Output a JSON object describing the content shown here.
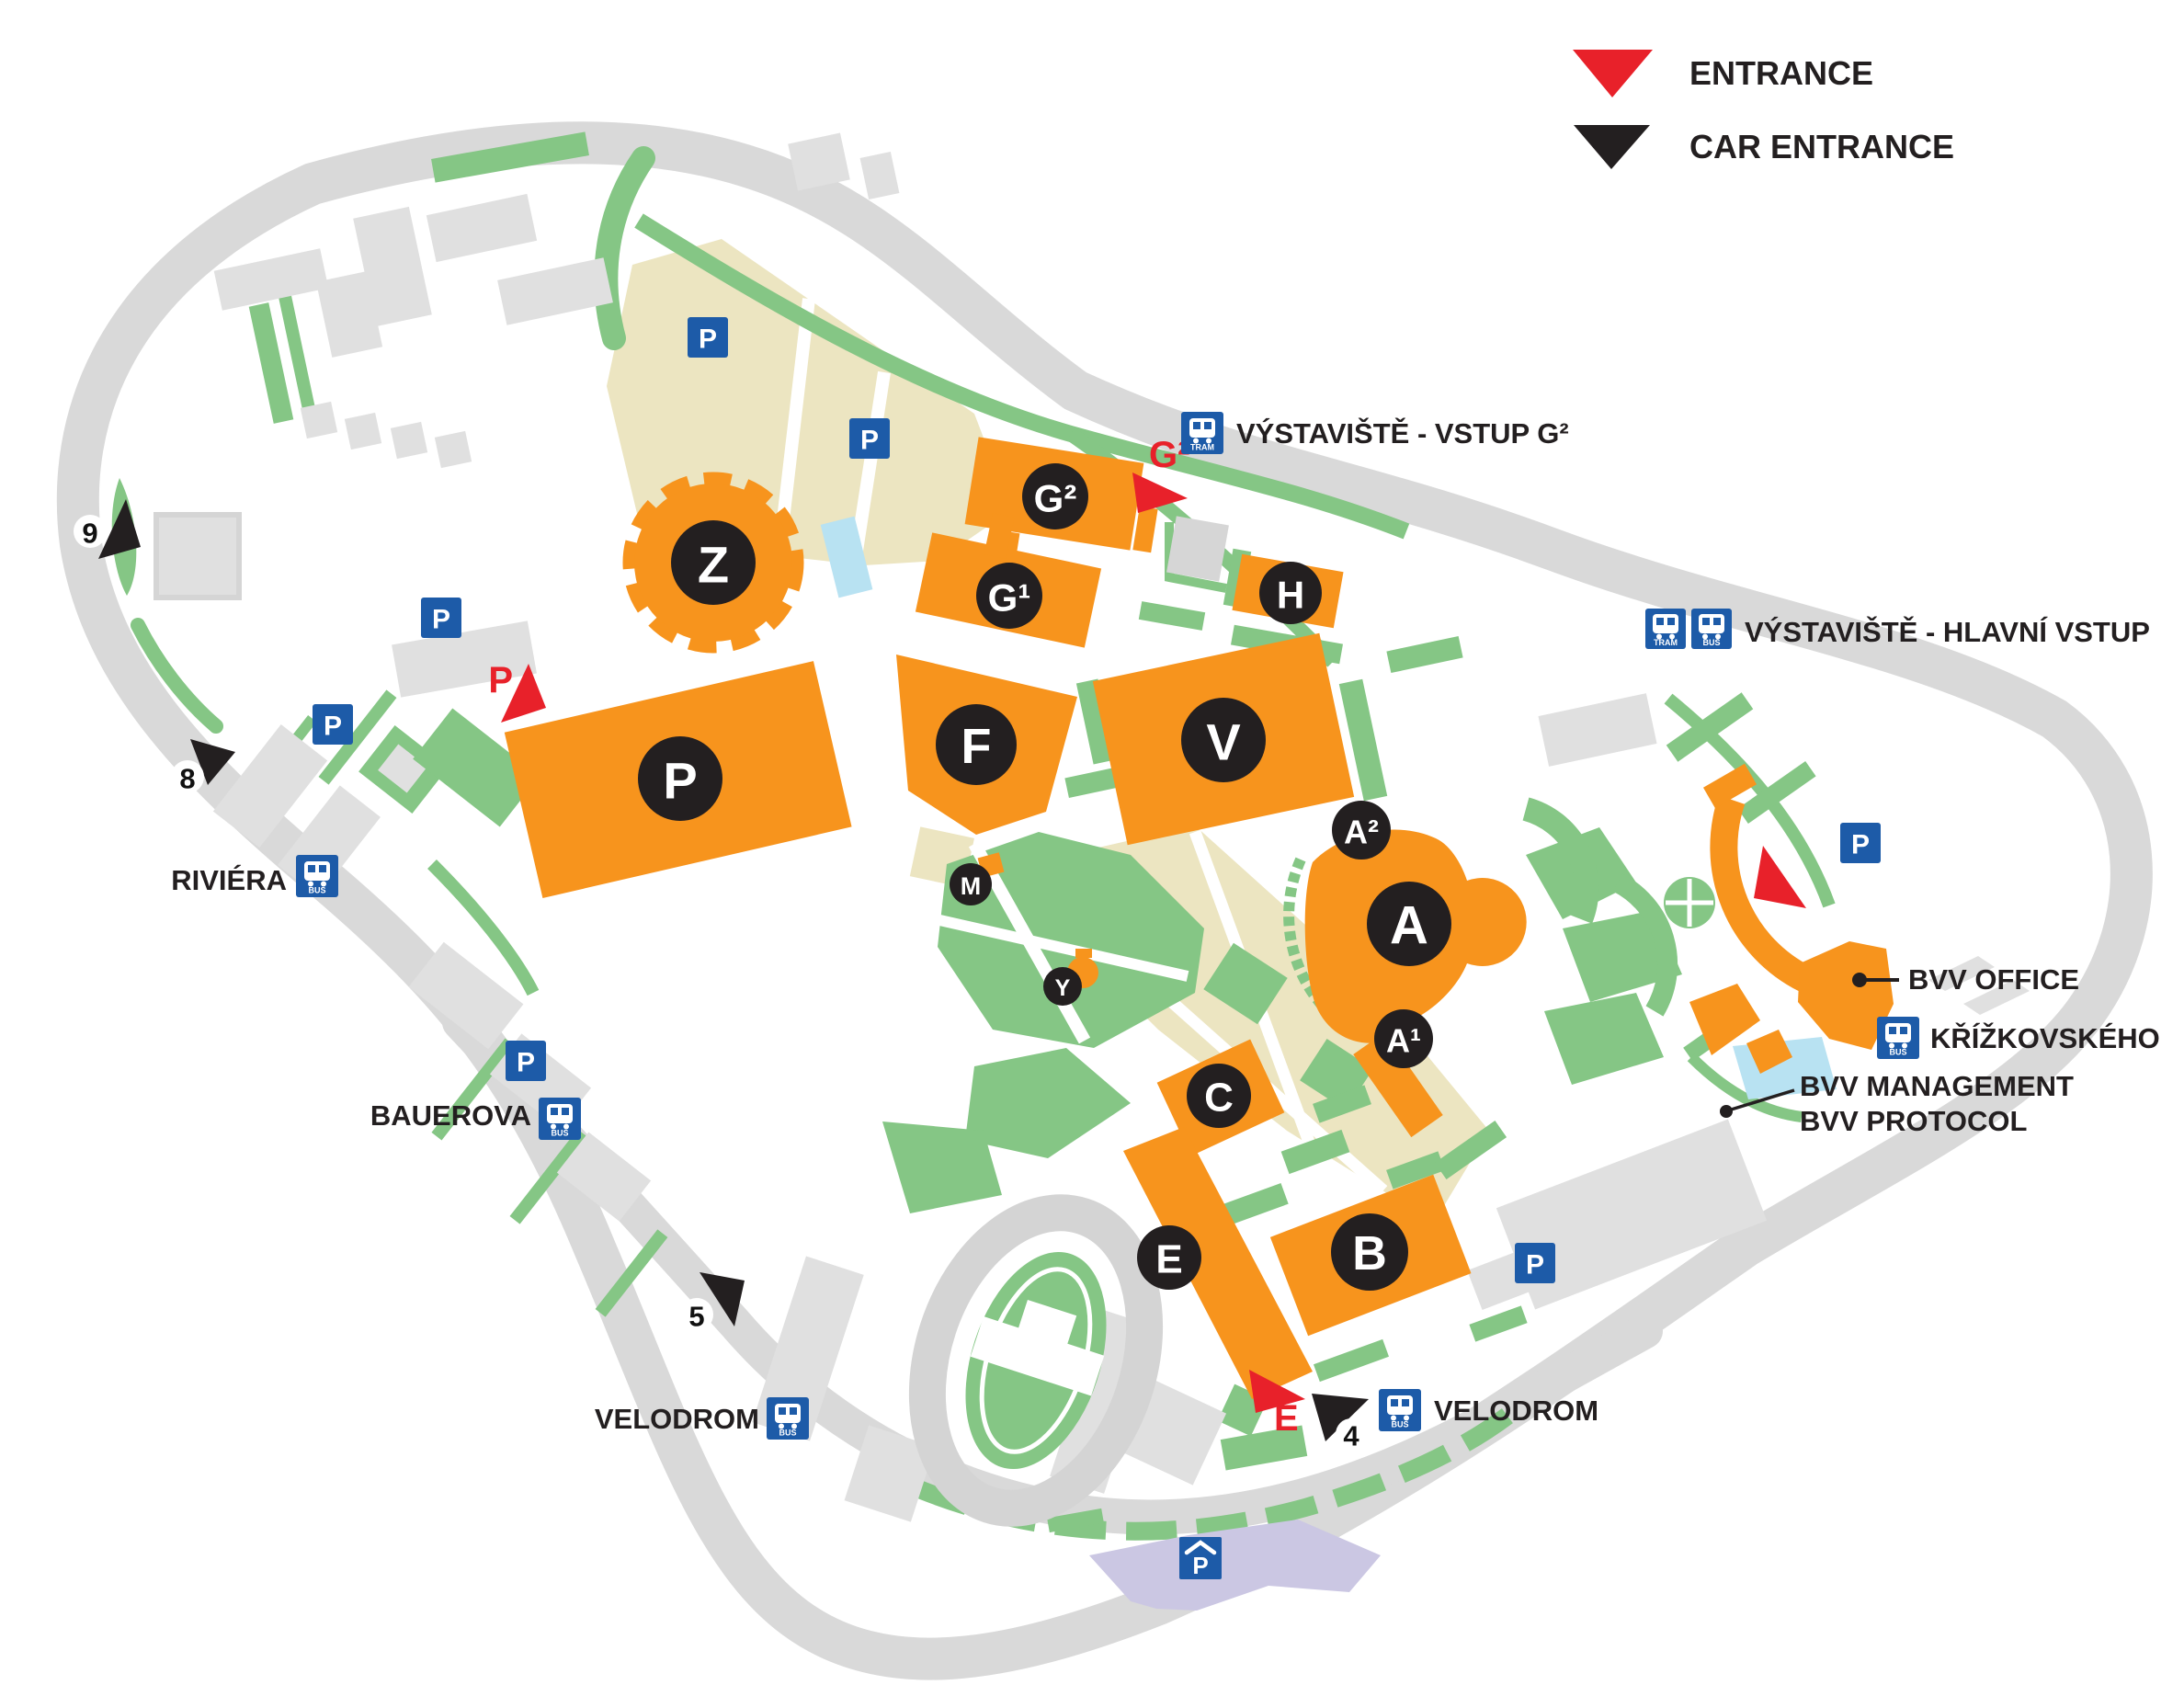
{
  "legend": {
    "entrance": "ENTRANCE",
    "car_entrance": "CAR ENTRANCE"
  },
  "pavilions": {
    "z": "Z",
    "p": "P",
    "f": "F",
    "v": "V",
    "g2": "G²",
    "g1": "G¹",
    "h": "H",
    "a": "A",
    "a2": "A²",
    "a1": "A¹",
    "c": "C",
    "b": "B",
    "e": "E",
    "m": "M",
    "y": "Y"
  },
  "entrances": {
    "g2": "G²",
    "p": "P",
    "e": "E"
  },
  "car_entrances": {
    "n9": "9",
    "n8": "8",
    "n5": "5",
    "n4": "4"
  },
  "transit": {
    "tram_label": "TRAM",
    "bus_label": "BUS",
    "stops": {
      "vstup_g2": "VÝSTAVIŠTĚ - VSTUP G²",
      "hlavni_vstup": "VÝSTAVIŠTĚ - HLAVNÍ VSTUP",
      "riviera": "RIVIÉRA",
      "bauerova": "BAUEROVA",
      "velodrom_west": "VELODROM",
      "velodrom_east": "VELODROM",
      "krizkovskeho": "KŘÍŽKOVSKÉHO"
    }
  },
  "parking": {
    "letter": "P",
    "garage_letter": "P"
  },
  "offices": {
    "bvv_office": "BVV OFFICE",
    "bvv_management": "BVV MANAGEMENT",
    "bvv_protocol": "BVV PROTOCOL"
  },
  "colors": {
    "pavilion_orange": "#F7941D",
    "label_black": "#231F20",
    "entrance_red": "#E8212A",
    "transit_blue": "#1D5BA8",
    "green": "#85C685",
    "beige": "#ECE5C1",
    "road_gray": "#D9D9D9",
    "building_gray": "#E0E0E0",
    "water_blue": "#B8E2F2",
    "purple": "#CBC7E3"
  }
}
